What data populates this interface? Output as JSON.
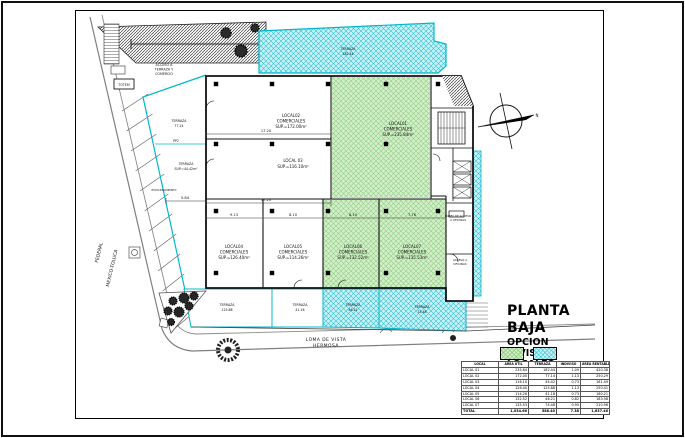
{
  "title_block": {
    "title": "PLANTA BAJA",
    "subtitle1": "OPCION",
    "subtitle2": "DIVISION LOCALES"
  },
  "streets": {
    "left_road_line1": "FEDERAL",
    "left_road_line2": "MEXICO-TOLUCA",
    "bottom_road_line1": "LOMA  DE  VISTA",
    "bottom_road_line2": "HERMOSA"
  },
  "locals": {
    "local01": {
      "l1": "LOCAL01",
      "l2": "COMERCIALES",
      "l3": "SUP.=235.84m²"
    },
    "local02": {
      "l1": "LOCAL02",
      "l2": "COMERCIALES",
      "l3": "SUP.=172.00m²"
    },
    "local03": {
      "l1": "LOCAL 03",
      "l2": "SUP.=116.10m²"
    },
    "local04": {
      "l1": "LOCAL04",
      "l2": "COMERCIALES",
      "l3": "SUP.=126.40m²"
    },
    "local05": {
      "l1": "LOCAL05",
      "l2": "COMERCIALES",
      "l3": "SUP.=114.26m²"
    },
    "local06": {
      "l1": "LOCAL06",
      "l2": "COMERCIALES",
      "l3": "SUP.=132.52m²"
    },
    "local07": {
      "l1": "LOCAL07",
      "l2": "COMERCIALES",
      "l3": "SUP.=135.53m²"
    }
  },
  "terraces": {
    "top": {
      "l1": "TERRAZA",
      "l2": "182.44"
    },
    "left_upper": {
      "l1": "TERRAZA",
      "l2": "77.14"
    },
    "left_mid": {
      "l1": "TERRAZA",
      "l2": "SUP.=44.42m²"
    },
    "bottom1": {
      "l1": "TERRAZA",
      "l2": "125.88"
    },
    "bottom2": {
      "l1": "TERRAZA",
      "l2": "41.18"
    },
    "bottom3": {
      "l1": "TERRAZA",
      "l2": "46.21"
    },
    "bottom4": {
      "l1": "TERRAZA",
      "l2": "74.48"
    }
  },
  "annotations": {
    "access_terrace": {
      "l1": "ACCESO A",
      "l2": "TERRAZA Y",
      "l3": "COMERCIO"
    },
    "lobby": {
      "l1": "LOBBY DE ACCESO",
      "l2": "A OFICINAS"
    },
    "office_access": {
      "l1": "ACCESO A",
      "l2": "OFICINAS"
    },
    "totem": "TOTEM",
    "pp2": "PP2",
    "parking": "ESTACIONAMIENTO",
    "north": "N"
  },
  "dimensions": {
    "d1": "17.20",
    "d2": "17.20",
    "d3": "9.13",
    "d4": "8.10",
    "d5": "8.10",
    "d6": "7.76",
    "d7": "5.84"
  },
  "colors": {
    "terrace_cyan_fill": "#c9f2f6",
    "terrace_cyan_line": "#00b8cc",
    "local_green_fill": "#d4efc8",
    "local_green_line": "#8fce88"
  },
  "table": {
    "headers": [
      "LOCAL",
      "ÁREA ÚTIL",
      "TERRAZA",
      "INDIVISO",
      "ÁREA RENTABLE"
    ],
    "rows": [
      [
        "LOCAL 01",
        "235.84",
        "182.44",
        "1.09",
        "420.38"
      ],
      [
        "LOCAL 02",
        "172.00",
        "77.14",
        "1.13",
        "250.29"
      ],
      [
        "LOCAL 03",
        "116.10",
        "44.42",
        "0.73",
        "161.49"
      ],
      [
        "LOCAL 04",
        "126.40",
        "125.88",
        "1.13",
        "250.41"
      ],
      [
        "LOCAL 05",
        "114.26",
        "41.18",
        "0.73",
        "160.21"
      ],
      [
        "LOCAL 06",
        "132.52",
        "46.21",
        "0.82",
        "183.98"
      ],
      [
        "LOCAL 07",
        "135.53",
        "74.48",
        "0.95",
        "210.96"
      ],
      [
        "TOTAL",
        "1,034.66",
        "588.40",
        "7.38",
        "1,637.46"
      ]
    ]
  }
}
